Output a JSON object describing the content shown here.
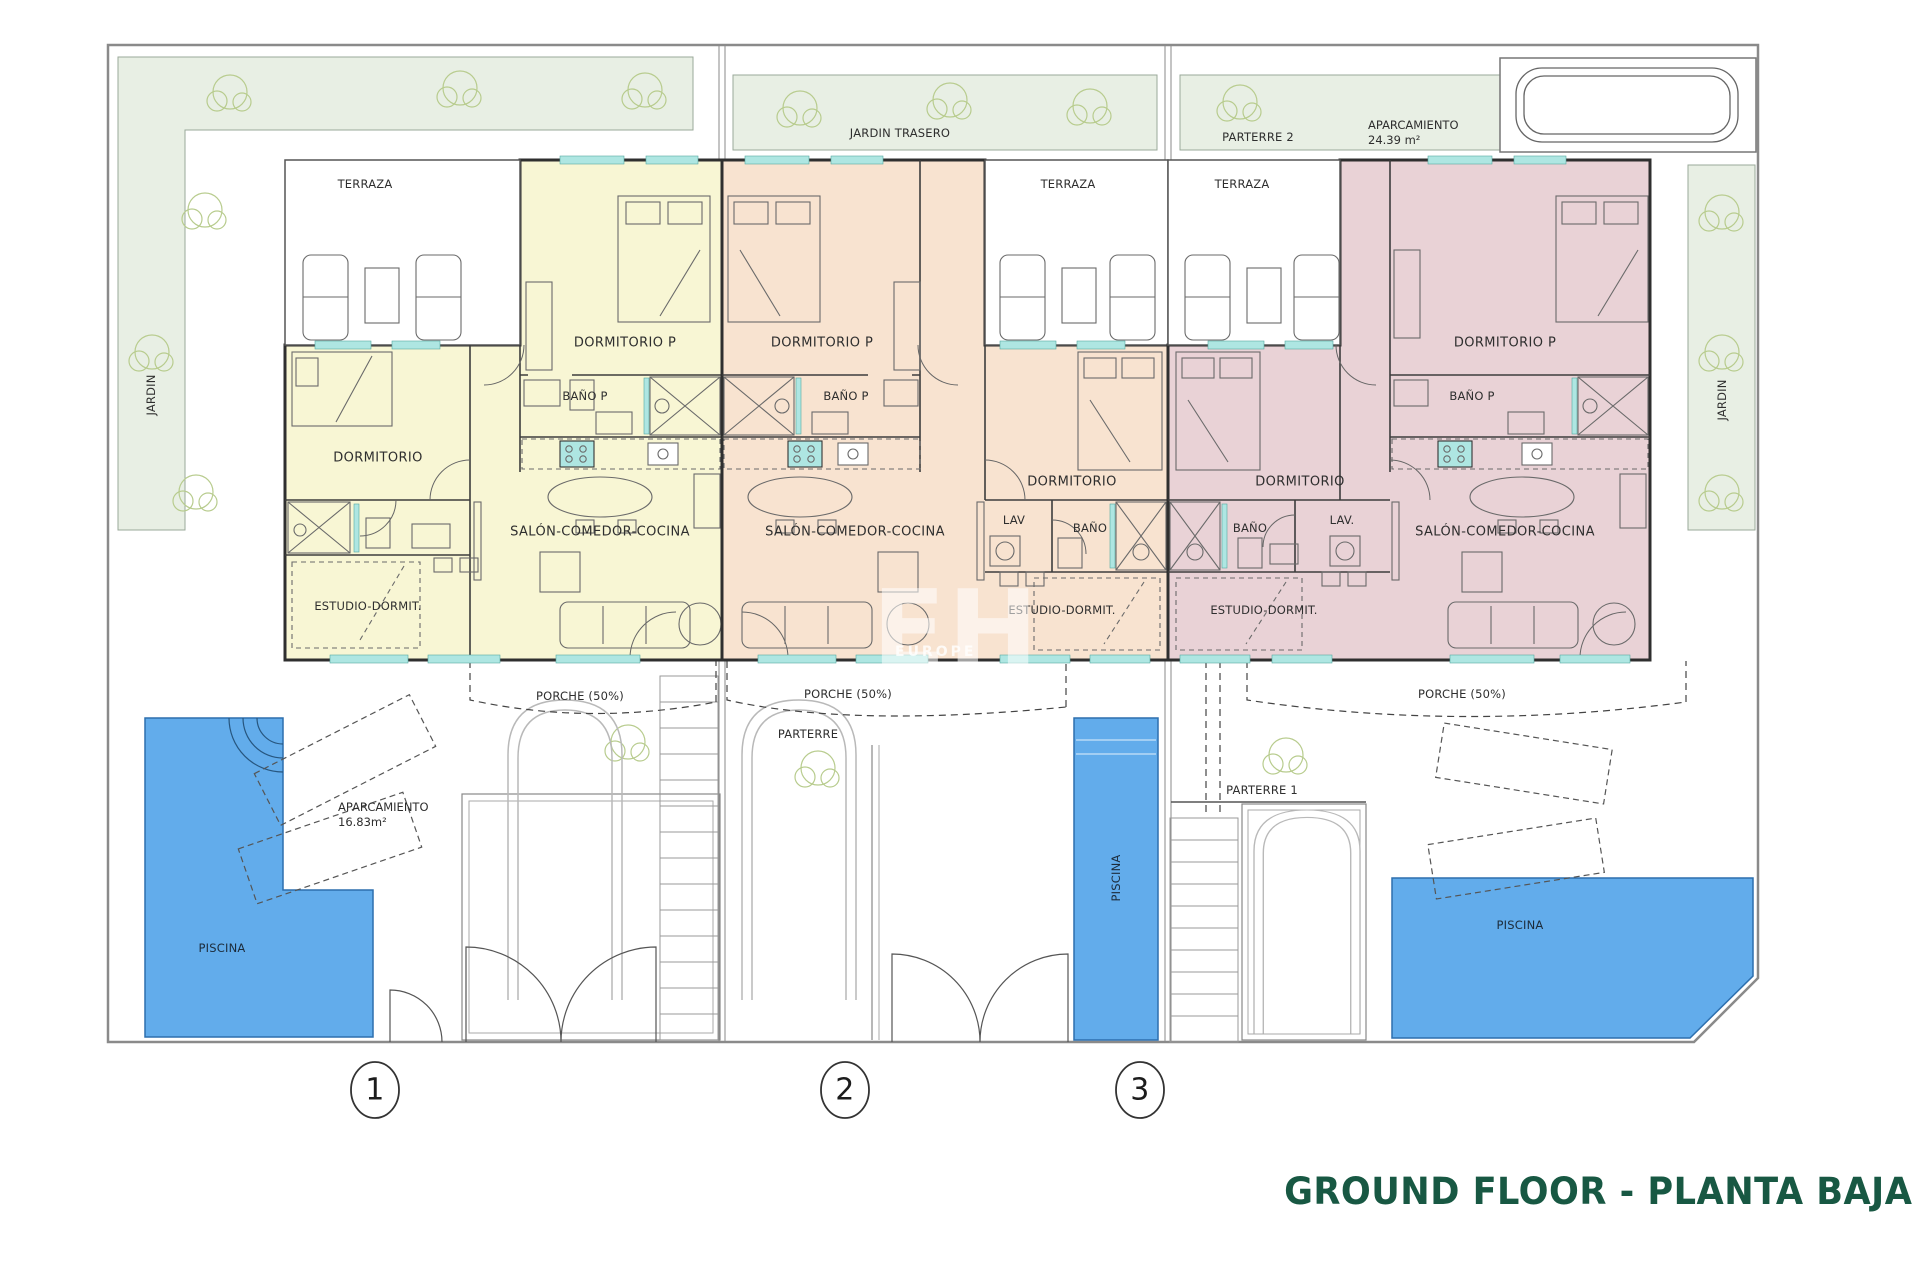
{
  "title": "GROUND FLOOR - PLANTA BAJA",
  "site": {
    "jardin_left": "JARDIN",
    "jardin_right": "JARDIN",
    "jardin_trasero": "JARDIN TRASERO",
    "parterre2": "PARTERRE 2",
    "aparcamiento_label": "APARCAMIENTO",
    "aparcamiento_area": "24.39 m²"
  },
  "units": [
    {
      "number": "1",
      "fill": "#f8f6d4",
      "labels": {
        "terraza": "TERRAZA",
        "dormitorio_p": "DORMITORIO P",
        "bano_p": "BAÑO P",
        "dormitorio": "DORMITORIO",
        "salon": "SALÓN-COMEDOR-COCINA",
        "estudio": "ESTUDIO-DORMIT.",
        "porche": "PORCHE (50%)",
        "piscina": "PISCINA",
        "aparcamiento_label": "APARCAMIENTO",
        "aparcamiento_area": "16.83m²"
      }
    },
    {
      "number": "2",
      "fill": "#f8e3d0",
      "labels": {
        "terraza": "TERRAZA",
        "dormitorio_p": "DORMITORIO P",
        "bano_p": "BAÑO P",
        "dormitorio": "DORMITORIO",
        "lav": "LAV",
        "bano": "BAÑO",
        "salon": "SALÓN-COMEDOR-COCINA",
        "estudio": "ESTUDIO-DORMIT.",
        "porche": "PORCHE (50%)",
        "parterre": "PARTERRE",
        "piscina": "PISCINA"
      }
    },
    {
      "number": "3",
      "fill": "#e9d2d6",
      "labels": {
        "terraza": "TERRAZA",
        "dormitorio_p": "DORMITORIO P",
        "bano_p": "BAÑO P",
        "dormitorio": "DORMITORIO",
        "lav": "LAV.",
        "bano": "BAÑO",
        "salon": "SALÓN-COMEDOR-COCINA",
        "estudio": "ESTUDIO-DORMIT.",
        "porche": "PORCHE (50%)",
        "parterre": "PARTERRE 1",
        "piscina": "PISCINA"
      }
    }
  ],
  "watermark": {
    "initials": "EH",
    "name": "EUROPE"
  },
  "colors": {
    "garden": "#e8efe4",
    "pool": "#62aceb",
    "window": "#aee6e2",
    "title_green": "#185843",
    "unit1": "#f8f6d4",
    "unit2": "#f8e3d0",
    "unit3": "#e9d2d6"
  }
}
